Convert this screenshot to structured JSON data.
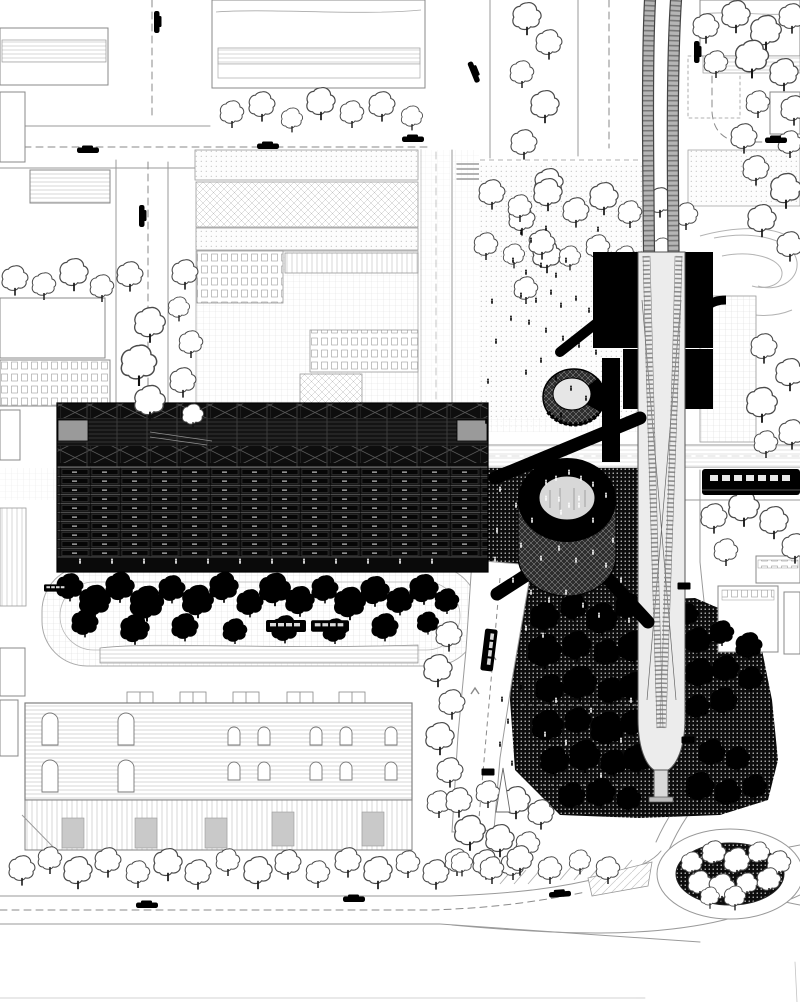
{
  "meta": {
    "title": "Black-and-white architectural site plan — urban masterplan with monorail, station block, long slab building, circular pavilions, tree park and roundabout",
    "drawing_style": "line drawing, hatched textures, no text labels"
  },
  "palette": {
    "paper": "#ffffff",
    "ink": "#000000",
    "dark_building": "#141414",
    "panel_gray": "#9a9a9a",
    "capsule_gray": "#ececec",
    "line_gray": "#999999",
    "hatch_gray": "#c9c9c9"
  },
  "scene": {
    "labels": {
      "city_blocks": "surrounding city blocks with hatched roofs",
      "main_building": "long dark slab building with truss roof and window bands",
      "station_box": "black station box over monorail",
      "monorail": "elevated monorail guideway tapering to ground mast",
      "ring_pavilion": "circular ring pavilion on dark plaza",
      "round_pavilion": "round hatched pavilion",
      "dark_plaza": "dark stippled public plaza with people",
      "tree_park": "dense park of black trees",
      "warehouse": "long industrial hall with arched windows",
      "roundabout": "planted oval roundabout island",
      "train": "train on east-west corridor"
    },
    "trees_outline": [
      [
        15,
        278,
        1.1
      ],
      [
        44,
        284,
        1.0
      ],
      [
        74,
        272,
        1.2
      ],
      [
        102,
        286,
        1.0
      ],
      [
        130,
        274,
        1.1
      ],
      [
        150,
        322,
        1.3
      ],
      [
        139,
        362,
        1.5
      ],
      [
        150,
        400,
        1.3
      ],
      [
        185,
        272,
        1.1
      ],
      [
        179,
        307,
        0.9
      ],
      [
        191,
        342,
        1.0
      ],
      [
        183,
        380,
        1.1
      ],
      [
        193,
        414,
        0.9
      ],
      [
        232,
        112,
        1.0
      ],
      [
        262,
        104,
        1.1
      ],
      [
        292,
        118,
        0.9
      ],
      [
        321,
        101,
        1.2
      ],
      [
        352,
        112,
        1.0
      ],
      [
        382,
        104,
        1.1
      ],
      [
        412,
        116,
        0.9
      ],
      [
        527,
        16,
        1.2
      ],
      [
        549,
        42,
        1.1
      ],
      [
        522,
        72,
        1.0
      ],
      [
        545,
        104,
        1.2
      ],
      [
        524,
        142,
        1.1
      ],
      [
        549,
        182,
        1.2
      ],
      [
        522,
        218,
        1.1
      ],
      [
        547,
        254,
        1.2
      ],
      [
        526,
        288,
        1.0
      ],
      [
        706,
        26,
        1.1
      ],
      [
        736,
        14,
        1.2
      ],
      [
        766,
        30,
        1.3
      ],
      [
        792,
        16,
        1.1
      ],
      [
        716,
        62,
        1.0
      ],
      [
        752,
        56,
        1.4
      ],
      [
        784,
        72,
        1.2
      ],
      [
        794,
        108,
        1.1
      ],
      [
        758,
        102,
        1.0
      ],
      [
        744,
        136,
        1.1
      ],
      [
        790,
        142,
        1.0
      ],
      [
        756,
        168,
        1.1
      ],
      [
        786,
        188,
        1.3
      ],
      [
        762,
        218,
        1.2
      ],
      [
        790,
        244,
        1.1
      ],
      [
        492,
        192,
        1.1
      ],
      [
        520,
        206,
        1.0
      ],
      [
        548,
        192,
        1.2
      ],
      [
        576,
        210,
        1.1
      ],
      [
        604,
        196,
        1.2
      ],
      [
        630,
        212,
        1.0
      ],
      [
        486,
        244,
        1.0
      ],
      [
        514,
        254,
        0.9
      ],
      [
        542,
        242,
        1.1
      ],
      [
        570,
        256,
        0.9
      ],
      [
        598,
        246,
        1.0
      ],
      [
        626,
        256,
        0.9
      ],
      [
        660,
        200,
        1.1
      ],
      [
        686,
        214,
        1.0
      ],
      [
        662,
        248,
        0.9
      ],
      [
        714,
        516,
        1.1
      ],
      [
        744,
        506,
        1.3
      ],
      [
        774,
        520,
        1.2
      ],
      [
        795,
        546,
        1.1
      ],
      [
        726,
        550,
        1.0
      ],
      [
        764,
        346,
        1.1
      ],
      [
        790,
        372,
        1.2
      ],
      [
        762,
        402,
        1.3
      ],
      [
        792,
        432,
        1.1
      ],
      [
        766,
        442,
        1.0
      ],
      [
        449,
        634,
        1.1
      ],
      [
        438,
        668,
        1.2
      ],
      [
        452,
        702,
        1.1
      ],
      [
        440,
        736,
        1.2
      ],
      [
        450,
        770,
        1.1
      ],
      [
        439,
        802,
        1.0
      ],
      [
        459,
        800,
        1.1
      ],
      [
        488,
        792,
        1.0
      ],
      [
        516,
        800,
        1.2
      ],
      [
        541,
        812,
        1.1
      ],
      [
        470,
        830,
        1.3
      ],
      [
        500,
        838,
        1.2
      ],
      [
        528,
        843,
        1.0
      ],
      [
        457,
        860,
        1.0
      ],
      [
        486,
        862,
        1.1
      ],
      [
        513,
        864,
        1.0
      ],
      [
        22,
        868,
        1.1
      ],
      [
        50,
        858,
        1.0
      ],
      [
        78,
        870,
        1.2
      ],
      [
        108,
        860,
        1.1
      ],
      [
        138,
        872,
        1.0
      ],
      [
        168,
        862,
        1.2
      ],
      [
        198,
        872,
        1.1
      ],
      [
        228,
        860,
        1.0
      ],
      [
        258,
        870,
        1.2
      ],
      [
        288,
        862,
        1.1
      ],
      [
        318,
        872,
        1.0
      ],
      [
        348,
        860,
        1.1
      ],
      [
        378,
        870,
        1.2
      ],
      [
        408,
        862,
        1.0
      ],
      [
        436,
        872,
        1.1
      ],
      [
        462,
        862,
        0.9
      ],
      [
        492,
        868,
        1.0
      ],
      [
        520,
        858,
        1.1
      ],
      [
        550,
        868,
        1.0
      ],
      [
        580,
        860,
        0.9
      ],
      [
        608,
        868,
        1.0
      ],
      [
        692,
        862,
        0.9
      ],
      [
        714,
        852,
        1.0
      ],
      [
        737,
        860,
        1.1
      ],
      [
        759,
        852,
        0.9
      ],
      [
        779,
        862,
        1.0
      ],
      [
        700,
        882,
        1.0
      ],
      [
        722,
        886,
        1.1
      ],
      [
        747,
        883,
        0.9
      ],
      [
        769,
        879,
        1.0
      ],
      [
        735,
        896,
        0.9
      ],
      [
        710,
        896,
        0.8
      ]
    ],
    "trees_black": [
      [
        70,
        586,
        1.1
      ],
      [
        95,
        600,
        1.3
      ],
      [
        120,
        586,
        1.2
      ],
      [
        147,
        602,
        1.4
      ],
      [
        172,
        588,
        1.1
      ],
      [
        198,
        600,
        1.3
      ],
      [
        224,
        586,
        1.2
      ],
      [
        250,
        602,
        1.1
      ],
      [
        275,
        588,
        1.3
      ],
      [
        300,
        600,
        1.2
      ],
      [
        325,
        588,
        1.1
      ],
      [
        350,
        602,
        1.3
      ],
      [
        375,
        590,
        1.2
      ],
      [
        400,
        600,
        1.1
      ],
      [
        424,
        588,
        1.2
      ],
      [
        447,
        600,
        1.0
      ],
      [
        85,
        622,
        1.1
      ],
      [
        135,
        628,
        1.2
      ],
      [
        185,
        626,
        1.1
      ],
      [
        235,
        630,
        1.0
      ],
      [
        285,
        628,
        1.1
      ],
      [
        335,
        630,
        1.0
      ],
      [
        385,
        626,
        1.1
      ],
      [
        428,
        622,
        0.9
      ],
      [
        545,
        616,
        1.2
      ],
      [
        574,
        606,
        1.1
      ],
      [
        602,
        618,
        1.3
      ],
      [
        629,
        606,
        1.1
      ],
      [
        545,
        650,
        1.4
      ],
      [
        577,
        645,
        1.2
      ],
      [
        607,
        652,
        1.1
      ],
      [
        634,
        646,
        1.3
      ],
      [
        550,
        688,
        1.2
      ],
      [
        580,
        682,
        1.4
      ],
      [
        611,
        690,
        1.1
      ],
      [
        634,
        686,
        1.2
      ],
      [
        548,
        725,
        1.3
      ],
      [
        578,
        720,
        1.1
      ],
      [
        608,
        728,
        1.4
      ],
      [
        634,
        722,
        1.1
      ],
      [
        555,
        760,
        1.2
      ],
      [
        585,
        755,
        1.3
      ],
      [
        614,
        762,
        1.1
      ],
      [
        638,
        758,
        1.2
      ],
      [
        572,
        795,
        1.1
      ],
      [
        601,
        792,
        1.2
      ],
      [
        629,
        798,
        1.0
      ],
      [
        698,
        640,
        1.1
      ],
      [
        722,
        632,
        1.0
      ],
      [
        749,
        645,
        1.1
      ],
      [
        700,
        672,
        1.2
      ],
      [
        726,
        668,
        1.1
      ],
      [
        751,
        678,
        1.0
      ],
      [
        698,
        706,
        1.0
      ],
      [
        724,
        700,
        1.1
      ],
      [
        712,
        752,
        1.1
      ],
      [
        738,
        758,
        1.0
      ],
      [
        700,
        786,
        1.2
      ],
      [
        728,
        792,
        1.1
      ],
      [
        755,
        786,
        1.0
      ],
      [
        688,
        614,
        0.9
      ]
    ],
    "people_dark": [
      [
        521,
        233
      ],
      [
        531,
        241
      ],
      [
        546,
        229
      ],
      [
        513,
        261
      ],
      [
        526,
        273
      ],
      [
        541,
        266
      ],
      [
        556,
        276
      ],
      [
        566,
        261
      ],
      [
        521,
        296
      ],
      [
        536,
        301
      ],
      [
        551,
        293
      ],
      [
        561,
        306
      ],
      [
        576,
        299
      ],
      [
        589,
        311
      ],
      [
        511,
        319
      ],
      [
        529,
        323
      ],
      [
        546,
        331
      ],
      [
        563,
        339
      ],
      [
        579,
        346
      ],
      [
        596,
        353
      ],
      [
        541,
        361
      ],
      [
        526,
        373
      ],
      [
        556,
        379
      ],
      [
        571,
        389
      ],
      [
        586,
        399
      ],
      [
        601,
        409
      ],
      [
        616,
        419
      ],
      [
        561,
        416
      ],
      [
        492,
        302
      ],
      [
        496,
        342
      ],
      [
        488,
        382
      ],
      [
        486,
        422
      ],
      [
        612,
        300
      ],
      [
        624,
        262
      ],
      [
        598,
        230
      ],
      [
        502,
        700
      ],
      [
        508,
        722
      ],
      [
        500,
        745
      ],
      [
        512,
        764
      ],
      [
        521,
        688
      ]
    ],
    "people_light": [
      [
        80,
        562
      ],
      [
        112,
        562
      ],
      [
        144,
        562
      ],
      [
        176,
        562
      ],
      [
        208,
        562
      ],
      [
        240,
        562
      ],
      [
        272,
        562
      ],
      [
        304,
        562
      ],
      [
        336,
        562
      ],
      [
        368,
        562
      ],
      [
        400,
        562
      ],
      [
        432,
        562
      ],
      [
        500,
        490
      ],
      [
        516,
        506
      ],
      [
        532,
        521
      ],
      [
        546,
        499
      ],
      [
        561,
        513
      ],
      [
        579,
        506
      ],
      [
        593,
        521
      ],
      [
        606,
        496
      ],
      [
        521,
        546
      ],
      [
        541,
        559
      ],
      [
        559,
        549
      ],
      [
        576,
        561
      ],
      [
        593,
        553
      ],
      [
        606,
        566
      ],
      [
        513,
        581
      ],
      [
        531,
        593
      ],
      [
        549,
        601
      ],
      [
        566,
        593
      ],
      [
        583,
        606
      ],
      [
        599,
        616
      ],
      [
        511,
        616
      ],
      [
        526,
        629
      ],
      [
        543,
        636
      ],
      [
        613,
        541
      ],
      [
        621,
        581
      ],
      [
        629,
        621
      ],
      [
        497,
        531
      ],
      [
        495,
        560
      ],
      [
        546,
        483
      ],
      [
        556,
        479
      ],
      [
        581,
        479
      ],
      [
        593,
        485
      ],
      [
        569,
        473
      ],
      [
        559,
        500
      ],
      [
        569,
        506
      ],
      [
        579,
        499
      ],
      [
        556,
        701
      ],
      [
        591,
        711
      ],
      [
        621,
        741
      ],
      [
        566,
        743
      ],
      [
        601,
        776
      ],
      [
        631,
        701
      ],
      [
        545,
        735
      ]
    ],
    "cars": [
      [
        157,
        22,
        90
      ],
      [
        88,
        150,
        0
      ],
      [
        268,
        146,
        0
      ],
      [
        413,
        139,
        0
      ],
      [
        474,
        72,
        68
      ],
      [
        697,
        52,
        90
      ],
      [
        776,
        140,
        0
      ],
      [
        142,
        216,
        90
      ],
      [
        147,
        905,
        0
      ],
      [
        354,
        899,
        0
      ],
      [
        560,
        894,
        -4
      ]
    ],
    "buses": [
      [
        286,
        626,
        0,
        1.0
      ],
      [
        330,
        626,
        0,
        0.95
      ],
      [
        56,
        588,
        0,
        0.6
      ],
      [
        489,
        650,
        97,
        1.05
      ]
    ],
    "benches": [
      [
        684,
        586
      ],
      [
        688,
        740
      ],
      [
        488,
        772
      ]
    ]
  }
}
